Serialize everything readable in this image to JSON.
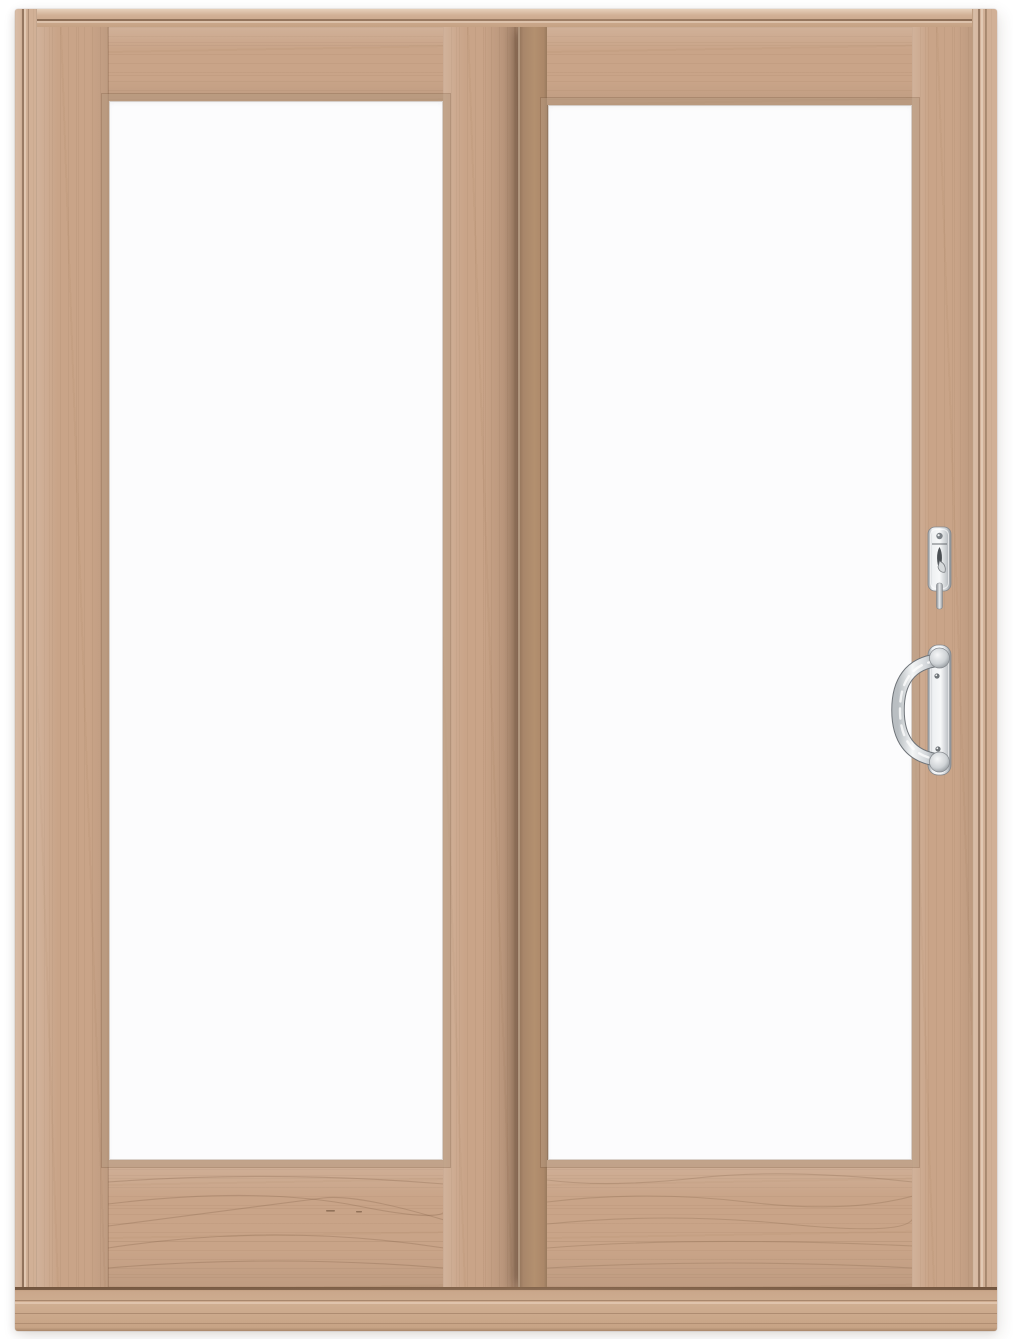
{
  "scene": {
    "type": "product-photo",
    "subject": "Two-panel wood sliding patio door with clear glass panes on a white background",
    "frame": "light unfinished wood jamb with routed groove detail and stepped sill",
    "panels": [
      {
        "position": "left",
        "role": "fixed-glass-panel",
        "glazing": "single clear pane"
      },
      {
        "position": "right",
        "role": "sliding-glass-panel",
        "glazing": "single clear pane",
        "overlap": "slides in front of left panel, casts shadow at meeting stile"
      }
    ],
    "hardware": [
      {
        "name": "thumb-turn-lock",
        "finish": "satin-chrome",
        "location": "right stile of sliding panel, upper"
      },
      {
        "name": "pull-handle",
        "finish": "satin-chrome",
        "location": "right stile of sliding panel, below lock"
      }
    ]
  },
  "colors": {
    "background": "#ffffff",
    "wood-base": "#c9a488",
    "wood-jamb": "#d1b096",
    "wood-light": "#e2cab2",
    "wood-shadow": "#96775b",
    "glass": "#fcfcfd",
    "chrome-light": "#f5f6f7",
    "chrome-mid": "#c9cdd1",
    "chrome-dark": "#8e9499",
    "hardware-detail": "#4b4f53"
  }
}
